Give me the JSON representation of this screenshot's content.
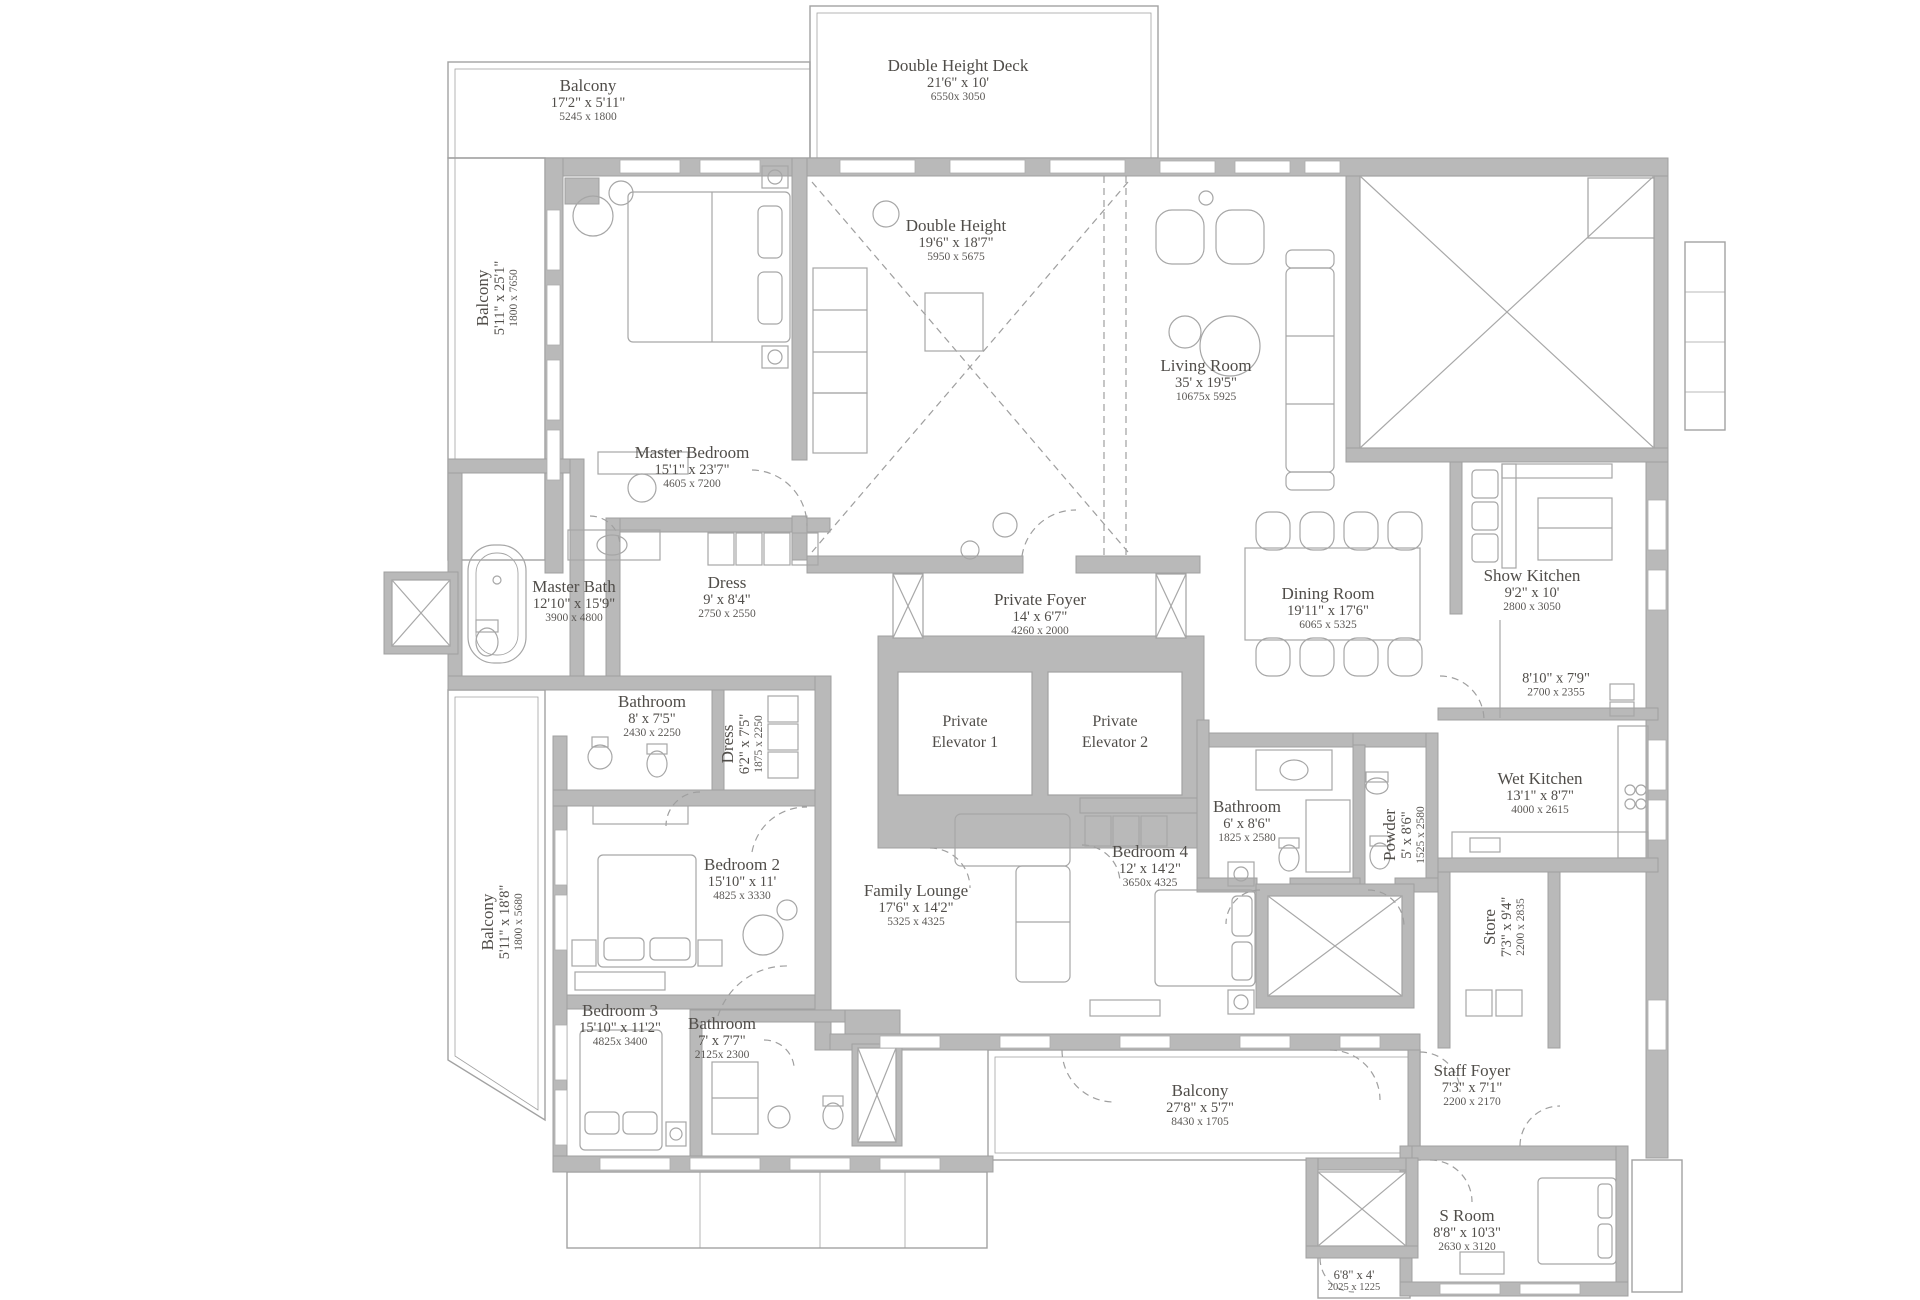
{
  "colors": {
    "wall": "#b9b9b9",
    "line": "#a2a2a2",
    "thin": "#a8a8a8",
    "text": "#504d49"
  },
  "rooms": {
    "balcony_top": {
      "name": "Balcony",
      "dims": "17'2\" x 5'11\"",
      "mm": "5245 x 1800"
    },
    "deck": {
      "name": "Double Height Deck",
      "dims": "21'6\" x 10'",
      "mm": "6550x 3050"
    },
    "balcony_left_upper": {
      "name": "Balcony",
      "dims": "5'11\" x 25'1\"",
      "mm": "1800 x 7650"
    },
    "master_bedroom": {
      "name": "Master Bedroom",
      "dims": "15'1\" x 23'7\"",
      "mm": "4605 x 7200"
    },
    "double_height": {
      "name": "Double Height",
      "dims": "19'6\" x 18'7\"",
      "mm": "5950 x 5675"
    },
    "living_room": {
      "name": "Living Room",
      "dims": "35' x 19'5\"",
      "mm": "10675x 5925"
    },
    "master_bath": {
      "name": "Master Bath",
      "dims": "12'10\" x 15'9\"",
      "mm": "3900 x 4800"
    },
    "dress_master": {
      "name": "Dress",
      "dims": "9' x 8'4\"",
      "mm": "2750 x 2550"
    },
    "private_foyer": {
      "name": "Private Foyer",
      "dims": "14' x 6'7\"",
      "mm": "4260 x 2000"
    },
    "dining_room": {
      "name": "Dining Room",
      "dims": "19'11\" x 17'6\"",
      "mm": "6065 x 5325"
    },
    "show_kitchen": {
      "name": "Show Kitchen",
      "dims": "9'2\" x 10'",
      "mm": "2800 x 3050"
    },
    "pantry": {
      "dims": "8'10\" x 7'9\"",
      "mm": "2700 x 2355"
    },
    "wet_kitchen": {
      "name": "Wet Kitchen",
      "dims": "13'1\" x 8'7\"",
      "mm": "4000 x 2615"
    },
    "private_elevator_1": {
      "name": "Private Elevator 1"
    },
    "private_elevator_2": {
      "name": "Private Elevator 2"
    },
    "bathroom4": {
      "name": "Bathroom",
      "dims": "6' x 8'6\"",
      "mm": "1825 x 2580"
    },
    "bedroom4": {
      "name": "Bedroom 4",
      "dims": "12' x 14'2\"",
      "mm": "3650x 4325"
    },
    "powder": {
      "name": "Powder",
      "dims": "5' x 8'6\"",
      "mm": "1525 x 2580"
    },
    "bathroom2": {
      "name": "Bathroom",
      "dims": "8' x 7'5\"",
      "mm": "2430 x 2250"
    },
    "dress2": {
      "name": "Dress",
      "dims": "6'2\" x 7'5\"",
      "mm": "1875 x 2250"
    },
    "bedroom2": {
      "name": "Bedroom 2",
      "dims": "15'10\" x 11'",
      "mm": "4825 x 3330"
    },
    "balcony_left_lower": {
      "name": "Balcony",
      "dims": "5'11\" x 18'8\"",
      "mm": "1800 x 5680"
    },
    "family_lounge": {
      "name": "Family Lounge",
      "dims": "17'6\" x 14'2\"",
      "mm": "5325 x 4325"
    },
    "bedroom3": {
      "name": "Bedroom 3",
      "dims": "15'10\" x 11'2\"",
      "mm": "4825x 3400"
    },
    "bathroom3": {
      "name": "Bathroom",
      "dims": "7' x 7'7\"",
      "mm": "2125x 2300"
    },
    "balcony_bottom": {
      "name": "Balcony",
      "dims": "27'8\" x 5'7\"",
      "mm": "8430 x 1705"
    },
    "staff_foyer": {
      "name": "Staff Foyer",
      "dims": "7'3\" x 7'1\"",
      "mm": "2200 x 2170"
    },
    "store": {
      "name": "Store",
      "dims": "7'3\" x 9'4\"",
      "mm": "2200 x 2835"
    },
    "s_room": {
      "name": "S Room",
      "dims": "8'8\" x 10'3\"",
      "mm": "2630 x 3120"
    },
    "small_balcony": {
      "dims": "6'8\" x 4'",
      "mm": "2025 x 1225"
    }
  }
}
